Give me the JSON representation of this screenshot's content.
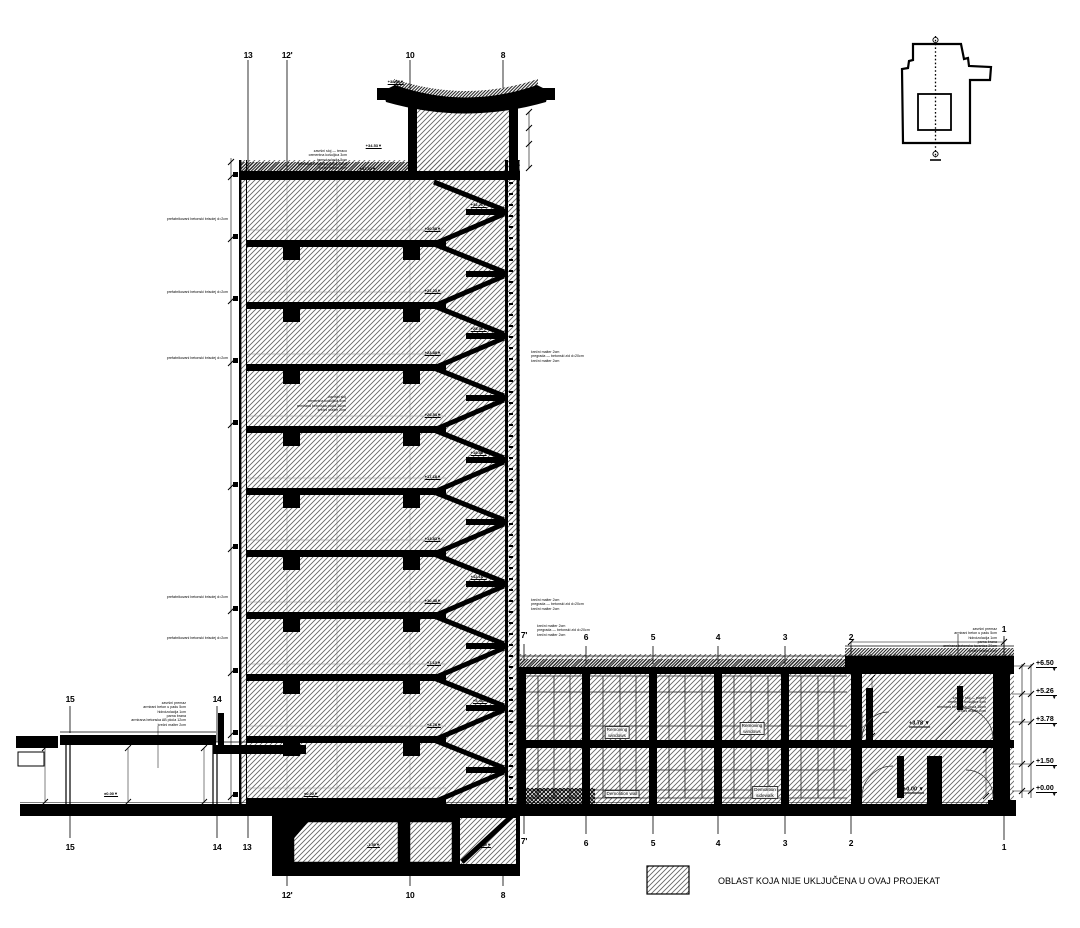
{
  "legend": {
    "label": "OBLAST KOJA NIJE UKLJUČENA U OVAJ PROJEKAT"
  },
  "grid_labels": [
    {
      "x": 248,
      "y": 50,
      "label": "13"
    },
    {
      "x": 287,
      "y": 50,
      "label": "12'"
    },
    {
      "x": 410,
      "y": 50,
      "label": "10"
    },
    {
      "x": 503,
      "y": 50,
      "label": "8"
    },
    {
      "x": 524,
      "y": 630,
      "label": "7'"
    },
    {
      "x": 586,
      "y": 632,
      "label": "6"
    },
    {
      "x": 653,
      "y": 632,
      "label": "5"
    },
    {
      "x": 718,
      "y": 632,
      "label": "4"
    },
    {
      "x": 785,
      "y": 632,
      "label": "3"
    },
    {
      "x": 851,
      "y": 632,
      "label": "2"
    },
    {
      "x": 1004,
      "y": 624,
      "label": "1"
    },
    {
      "x": 70,
      "y": 694,
      "label": "15"
    },
    {
      "x": 217,
      "y": 694,
      "label": "14"
    },
    {
      "x": 70,
      "y": 842,
      "label": "15"
    },
    {
      "x": 217,
      "y": 842,
      "label": "14"
    },
    {
      "x": 247,
      "y": 842,
      "label": "13"
    },
    {
      "x": 287,
      "y": 890,
      "label": "12'"
    },
    {
      "x": 410,
      "y": 890,
      "label": "10"
    },
    {
      "x": 503,
      "y": 890,
      "label": "8"
    },
    {
      "x": 524,
      "y": 836,
      "label": "7'"
    },
    {
      "x": 586,
      "y": 838,
      "label": "6"
    },
    {
      "x": 653,
      "y": 838,
      "label": "5"
    },
    {
      "x": 718,
      "y": 838,
      "label": "4"
    },
    {
      "x": 785,
      "y": 838,
      "label": "3"
    },
    {
      "x": 851,
      "y": 838,
      "label": "2"
    },
    {
      "x": 1004,
      "y": 842,
      "label": "1"
    }
  ],
  "levels_right": [
    {
      "x": 1036,
      "y": 660,
      "label": "+6.50"
    },
    {
      "x": 1036,
      "y": 688,
      "label": "+5.26"
    },
    {
      "x": 1036,
      "y": 716,
      "label": "+3.78"
    },
    {
      "x": 1036,
      "y": 758,
      "label": "+1.50"
    },
    {
      "x": 1036,
      "y": 785,
      "label": "+0.00"
    }
  ],
  "section_levels": [
    {
      "x": 930,
      "y": 724,
      "label": "+3.78"
    },
    {
      "x": 924,
      "y": 790,
      "label": "+0.00"
    }
  ],
  "levels_small": [
    {
      "x": 441,
      "y": 229,
      "label": "+30.58"
    },
    {
      "x": 441,
      "y": 291,
      "label": "+27.23"
    },
    {
      "x": 441,
      "y": 353,
      "label": "+23.88"
    },
    {
      "x": 441,
      "y": 415,
      "label": "+20.53"
    },
    {
      "x": 441,
      "y": 477,
      "label": "+17.18"
    },
    {
      "x": 441,
      "y": 539,
      "label": "+13.83"
    },
    {
      "x": 441,
      "y": 601,
      "label": "+10.48"
    },
    {
      "x": 441,
      "y": 663,
      "label": "+7.13"
    },
    {
      "x": 441,
      "y": 725,
      "label": "+3.78"
    },
    {
      "x": 487,
      "y": 205,
      "label": "+32.26"
    },
    {
      "x": 487,
      "y": 329,
      "label": "+25.56"
    },
    {
      "x": 487,
      "y": 453,
      "label": "+18.86"
    },
    {
      "x": 487,
      "y": 577,
      "label": "+12.16"
    },
    {
      "x": 487,
      "y": 701,
      "label": "+5.46"
    },
    {
      "x": 404,
      "y": 82,
      "label": "+38.50"
    },
    {
      "x": 382,
      "y": 146,
      "label": "+34.53"
    },
    {
      "x": 376,
      "y": 169,
      "label": "+33.93"
    },
    {
      "x": 426,
      "y": 174,
      "label": "+33.93"
    },
    {
      "x": 318,
      "y": 794,
      "label": "±0.00"
    },
    {
      "x": 118,
      "y": 794,
      "label": "±0.00"
    },
    {
      "x": 380,
      "y": 845,
      "label": "-1.50"
    },
    {
      "x": 491,
      "y": 845,
      "label": "-1.50"
    }
  ],
  "facade_notes": [
    {
      "x": 228,
      "y": 219,
      "label": "prefabrikovani betonski brisolej d=2cm"
    },
    {
      "x": 228,
      "y": 292,
      "label": "prefabrikovani betonski brisolej d=2cm"
    },
    {
      "x": 228,
      "y": 358,
      "label": "prefabrikovani betonski brisolej d=2cm"
    },
    {
      "x": 228,
      "y": 597,
      "label": "prefabrikovani betonski brisolej d=2cm"
    },
    {
      "x": 228,
      "y": 638,
      "label": "prefabrikovani betonski brisolej d=2cm"
    }
  ],
  "room_labels": [
    {
      "x": 617,
      "y": 726,
      "line1": "Removing",
      "line2": "windows"
    },
    {
      "x": 752,
      "y": 722,
      "line1": "Removing",
      "line2": "windows"
    },
    {
      "x": 622,
      "y": 790,
      "line1": "Demolition wall",
      "line2": ""
    },
    {
      "x": 765,
      "y": 786,
      "line1": "Demolition",
      "line2": "sidewalk"
    }
  ],
  "callouts": {
    "roof": {
      "lines": [
        "završni premaz",
        "armirani beton u padu 5cm",
        "hidroizolacija 1cm",
        "parna brana",
        "armirana betonska tavanica 20cm",
        "krečni malter 2cm"
      ]
    },
    "canopy": {
      "lines": [
        "završni premaz",
        "armirani beton u padu 5cm",
        "hidroizolacija 1cm",
        "parna brana",
        "armirana betonska AB ploča 12cm",
        "krečni malter 2cm"
      ]
    },
    "tower_top": {
      "lines": [
        "završni sloj — teraco",
        "cementna košuljica 3cm",
        "termoizolacija 5cm",
        "armirana betonska ploča 16cm",
        "krečni malter 2cm"
      ]
    },
    "tower_mid": {
      "lines": [
        "završni sloj",
        "cementna košuljica 3cm",
        "armirana betonska ploča 16cm",
        "krečni malter 2cm"
      ]
    },
    "right_section": {
      "lines": [
        "završni sloj — parket",
        "cementna košuljica 4cm",
        "armirana betonska ploča 16cm",
        "krečni malter 2cm"
      ]
    },
    "wall_a": {
      "lines": [
        "krečni malter 2cm",
        "pregrada — betonski zid d=20cm",
        "krečni malter 2cm"
      ]
    },
    "wall_b": {
      "lines": [
        "krečni malter 2cm",
        "pregrada — betonski zid d=20cm",
        "krečni malter 2cm"
      ]
    },
    "wall_c": {
      "lines": [
        "krečni malter 2cm",
        "pregrada — betonski zid d=20cm",
        "krečni malter 2cm"
      ]
    }
  }
}
